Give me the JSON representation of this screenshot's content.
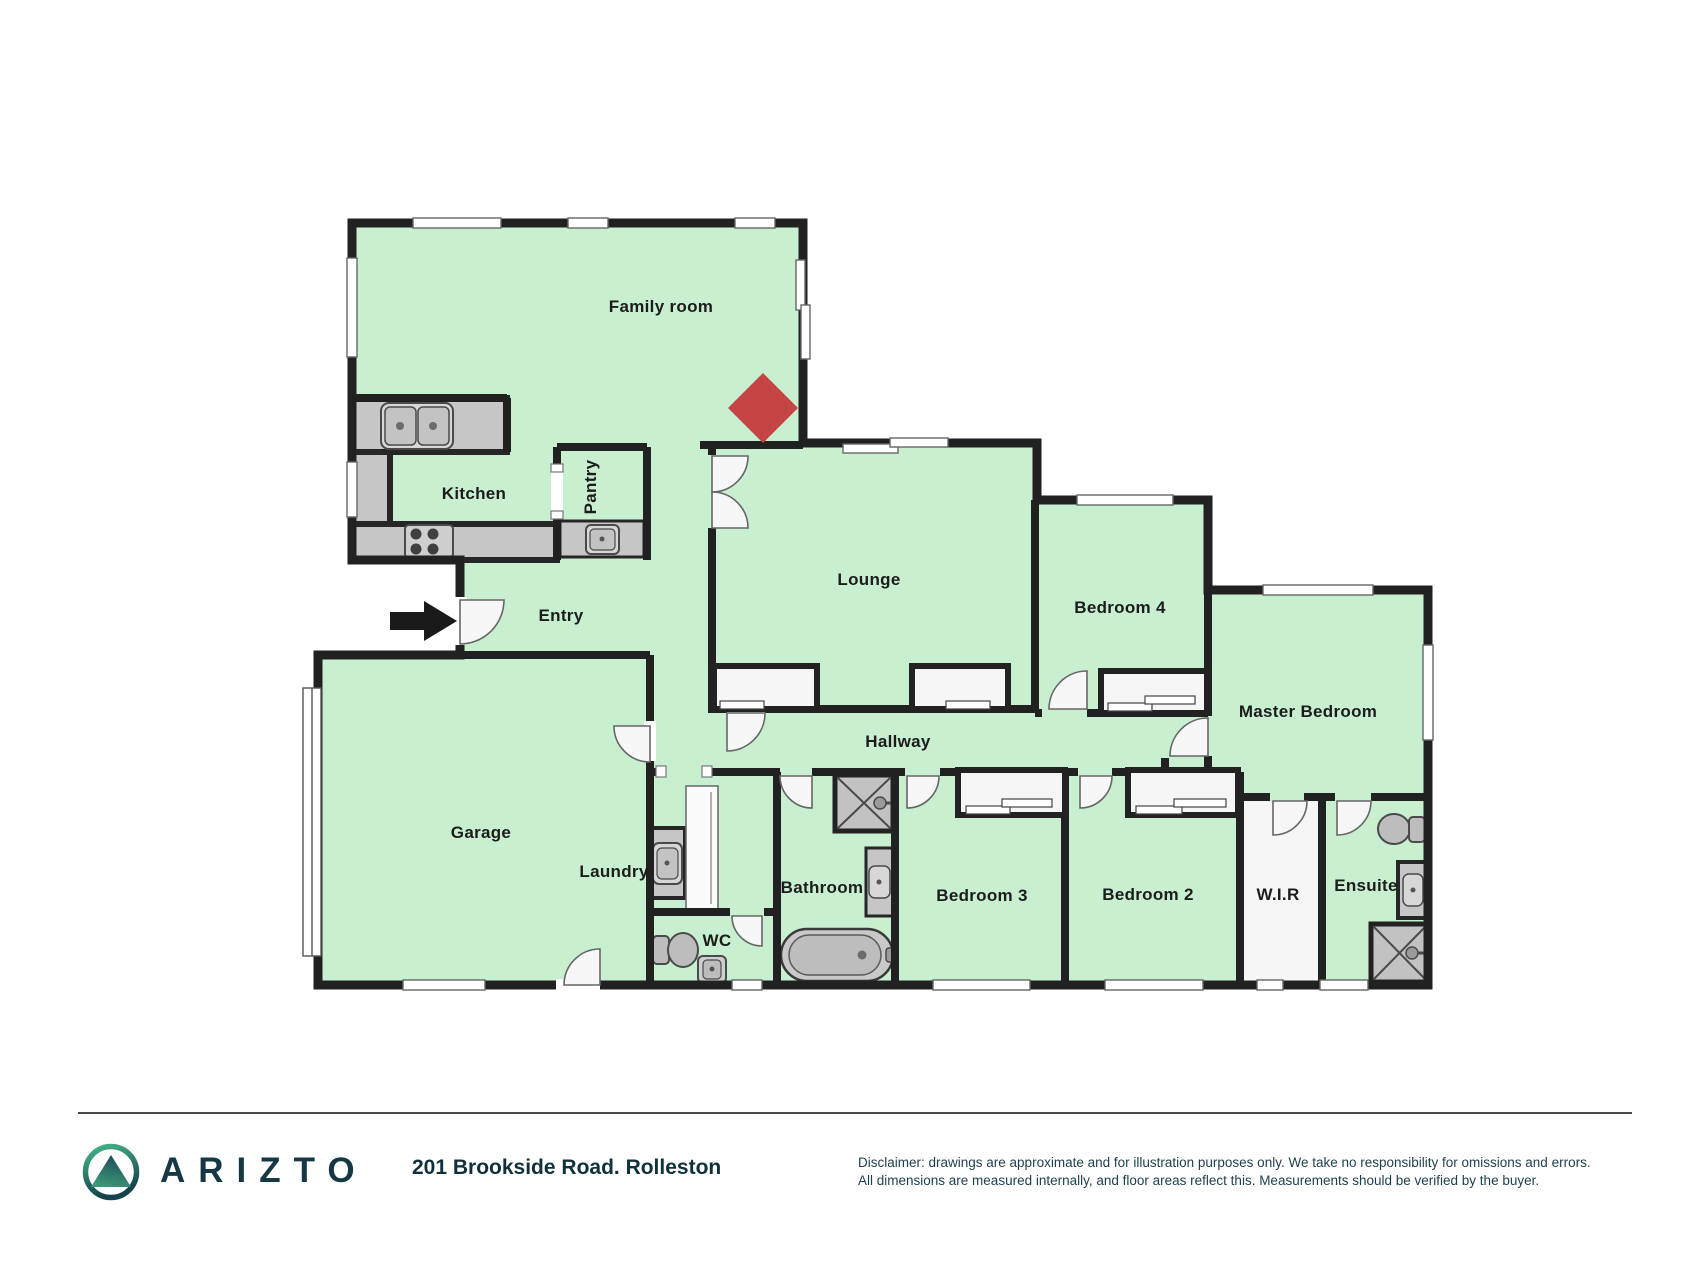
{
  "plan": {
    "rooms": [
      {
        "id": "family-room",
        "label": "Family room"
      },
      {
        "id": "kitchen",
        "label": "Kitchen"
      },
      {
        "id": "pantry",
        "label": "Pantry"
      },
      {
        "id": "entry",
        "label": "Entry"
      },
      {
        "id": "lounge",
        "label": "Lounge"
      },
      {
        "id": "bedroom-4",
        "label": "Bedroom 4"
      },
      {
        "id": "master-bedroom",
        "label": "Master Bedroom"
      },
      {
        "id": "garage",
        "label": "Garage"
      },
      {
        "id": "laundry",
        "label": "Laundry"
      },
      {
        "id": "wc",
        "label": "WC"
      },
      {
        "id": "bathroom",
        "label": "Bathroom"
      },
      {
        "id": "bedroom-3",
        "label": "Bedroom 3"
      },
      {
        "id": "bedroom-2",
        "label": "Bedroom 2"
      },
      {
        "id": "wir",
        "label": "W.I.R"
      },
      {
        "id": "ensuite",
        "label": "Ensuite"
      },
      {
        "id": "hallway",
        "label": "Hallway"
      }
    ],
    "icons": {
      "fireplace": "fireplace-diamond",
      "entry_arrow": "entry-direction-arrow"
    }
  },
  "colors": {
    "room_fill": "#c8f0d0",
    "wall": "#212121",
    "fireplace_red": "#c64444",
    "counter_gray": "#c6c6c6",
    "brand_teal": "#163844"
  },
  "footer": {
    "brand": "ARIZTO",
    "address": "201 Brookside Road. Rolleston",
    "disclaimer_line1": "Disclaimer: drawings are approximate and for illustration purposes only. We take no responsibility for omissions and errors.",
    "disclaimer_line2": "All dimensions are measured internally, and floor areas reflect this. Measurements should be verified by the buyer."
  }
}
